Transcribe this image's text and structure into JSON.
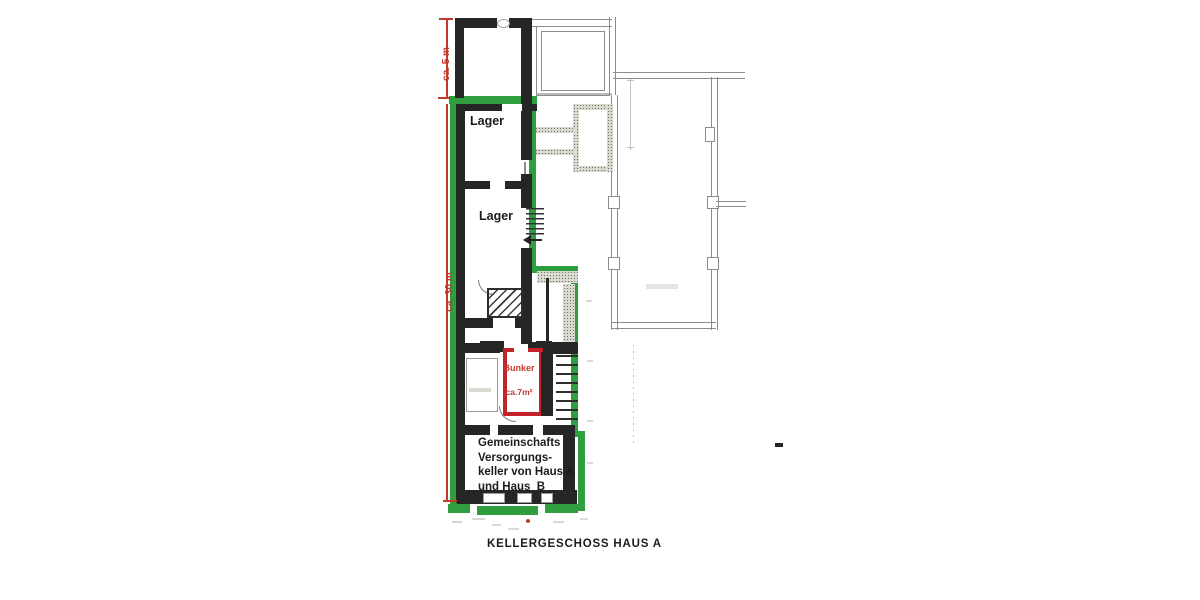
{
  "plan": {
    "title": "KELLERGESCHOSS HAUS A",
    "dimensions": {
      "left_upper": "ca. 5 m",
      "left_lower": "ca. 30 m"
    },
    "rooms": {
      "lager_upper": "Lager",
      "lager_lower": "Lager",
      "bunker": {
        "name": "Bunker",
        "area": "ca.7m²"
      },
      "gemeinschaftskeller": {
        "lines": [
          "Gemeinschafts",
          "Versorgungs-",
          "keller von Haus A",
          "und Haus  B"
        ]
      }
    },
    "colors": {
      "outline_green": "#2f9e3f",
      "dimension_red": "#c0392b",
      "bunker_red": "#c4232a",
      "wall_black": "#262626",
      "thin_line_gray": "#8c8c8c"
    }
  }
}
